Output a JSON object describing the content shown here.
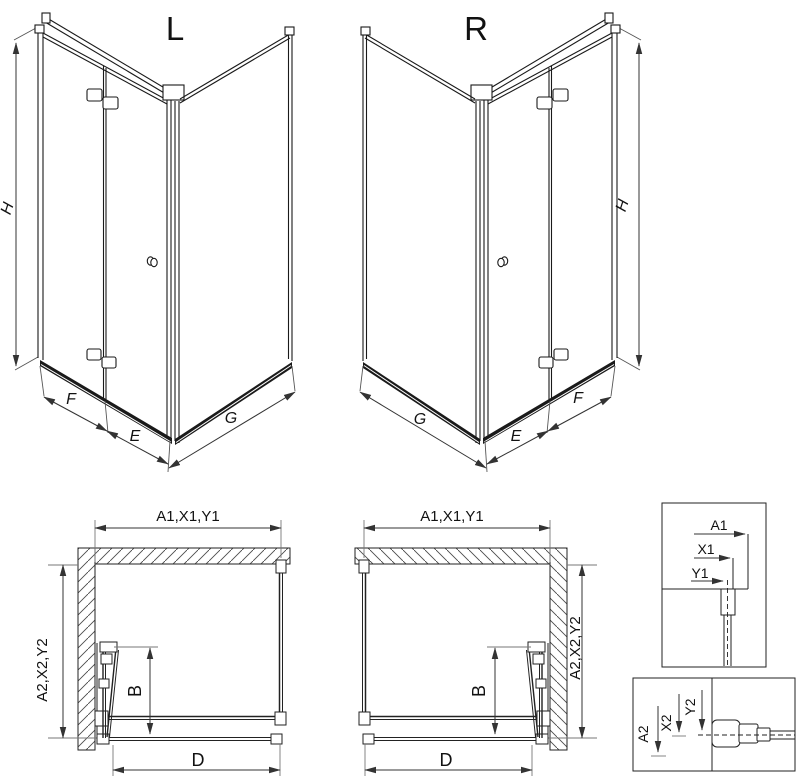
{
  "drawing": {
    "background": "#ffffff",
    "line_color": "#1a1a1a",
    "dim_line_color": "#333333",
    "iso_left": {
      "title": "L",
      "dim_height": "H",
      "dim_door": "F",
      "dim_door_ext": "E",
      "dim_side_panel": "G"
    },
    "iso_right": {
      "title": "R",
      "dim_height": "H",
      "dim_door": "F",
      "dim_door_ext": "E",
      "dim_side_panel": "G"
    },
    "plan_left": {
      "dim_width": "A1,X1,Y1",
      "dim_depth": "A2,X2,Y2",
      "dim_door_fold": "B",
      "dim_opening": "D"
    },
    "plan_right": {
      "dim_width": "A1,X1,Y1",
      "dim_depth": "A2,X2,Y2",
      "dim_door_fold": "B",
      "dim_opening": "D"
    },
    "detail_wall_profile": {
      "dim_a": "A1",
      "dim_x": "X1",
      "dim_y": "Y1"
    },
    "detail_floor_profile": {
      "dim_a": "A2",
      "dim_x": "X2",
      "dim_y": "Y2"
    }
  }
}
